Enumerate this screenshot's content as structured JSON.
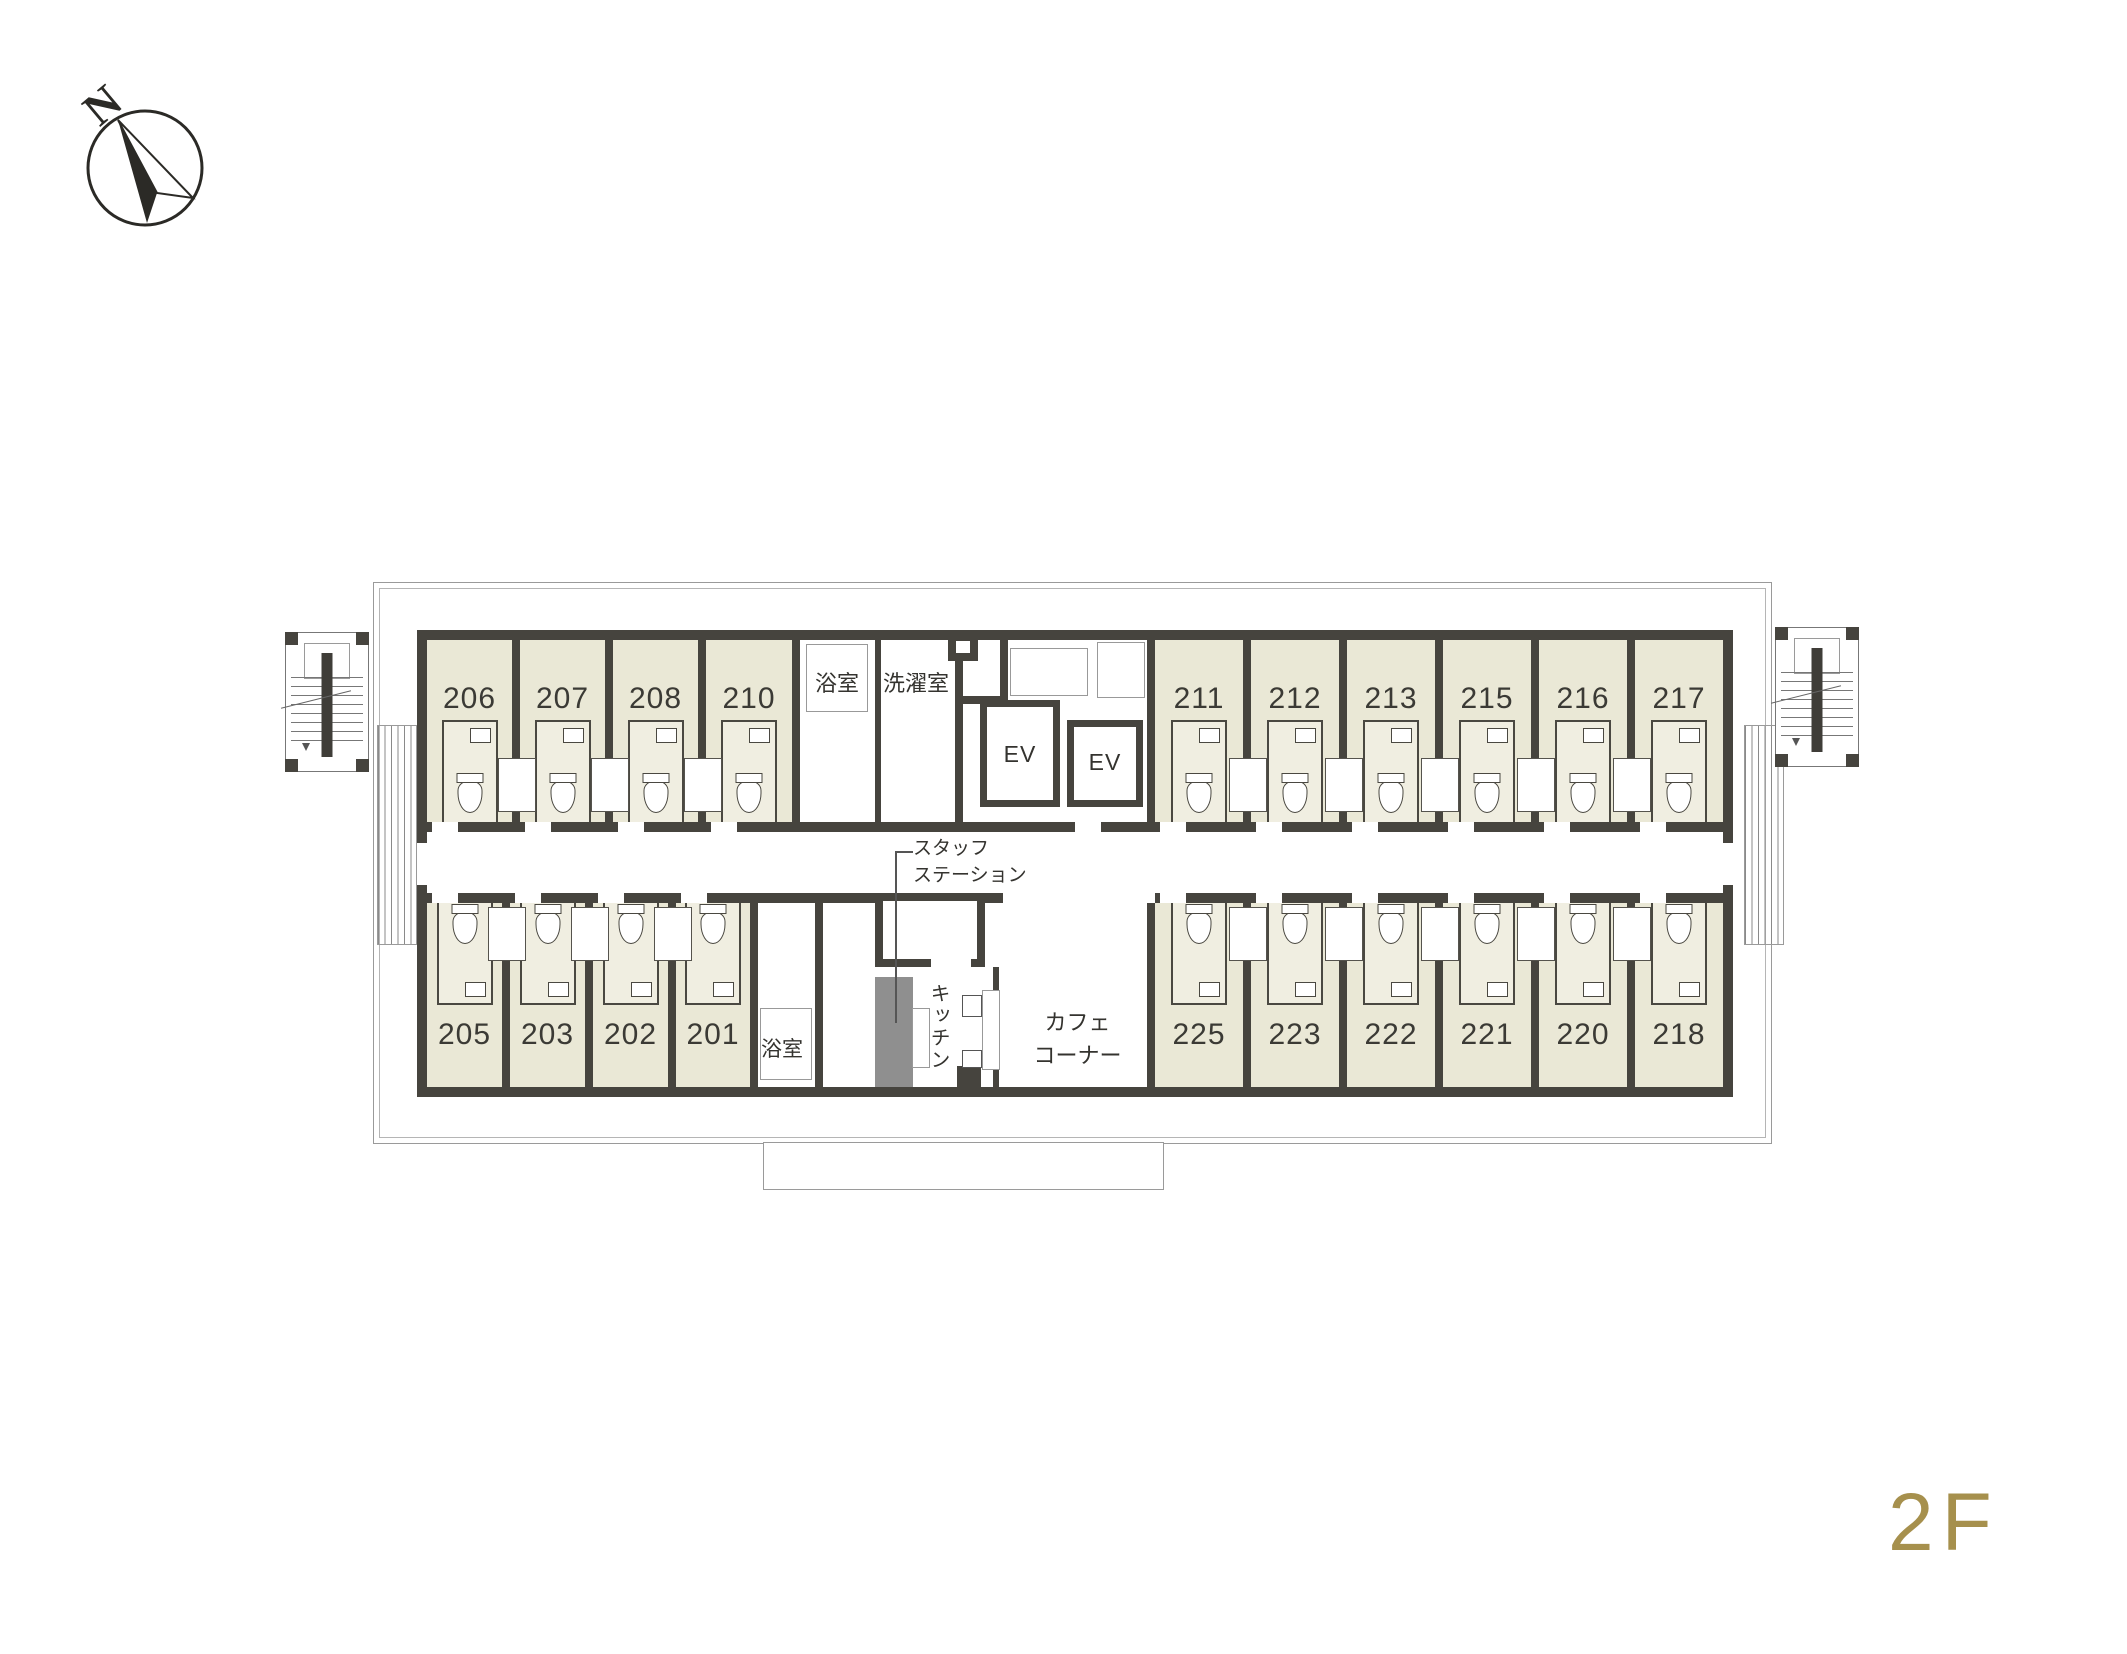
{
  "compass": {
    "label": "N"
  },
  "floor_label": "2F",
  "rooms": {
    "top_left": [
      "206",
      "207",
      "208",
      "210"
    ],
    "top_right": [
      "211",
      "212",
      "213",
      "215",
      "216",
      "217"
    ],
    "bottom_left": [
      "205",
      "203",
      "202",
      "201"
    ],
    "bottom_right": [
      "225",
      "223",
      "222",
      "221",
      "220",
      "218"
    ]
  },
  "labels": {
    "bath_top": "浴室",
    "laundry": "洗濯室",
    "ev1": "EV",
    "ev2": "EV",
    "staff_station_line1": "スタッフ",
    "staff_station_line2": "ステーション",
    "bath_bottom": "浴室",
    "kitchen": "キッチン",
    "cafe_line1": "カフェ",
    "cafe_line2": "コーナー"
  },
  "colors": {
    "room_fill": "#eae8d6",
    "wall": "#46443e",
    "accent_gold": "#a6904d",
    "line_gray": "#9a9a9a",
    "gray_block": "#8f8f8f"
  }
}
